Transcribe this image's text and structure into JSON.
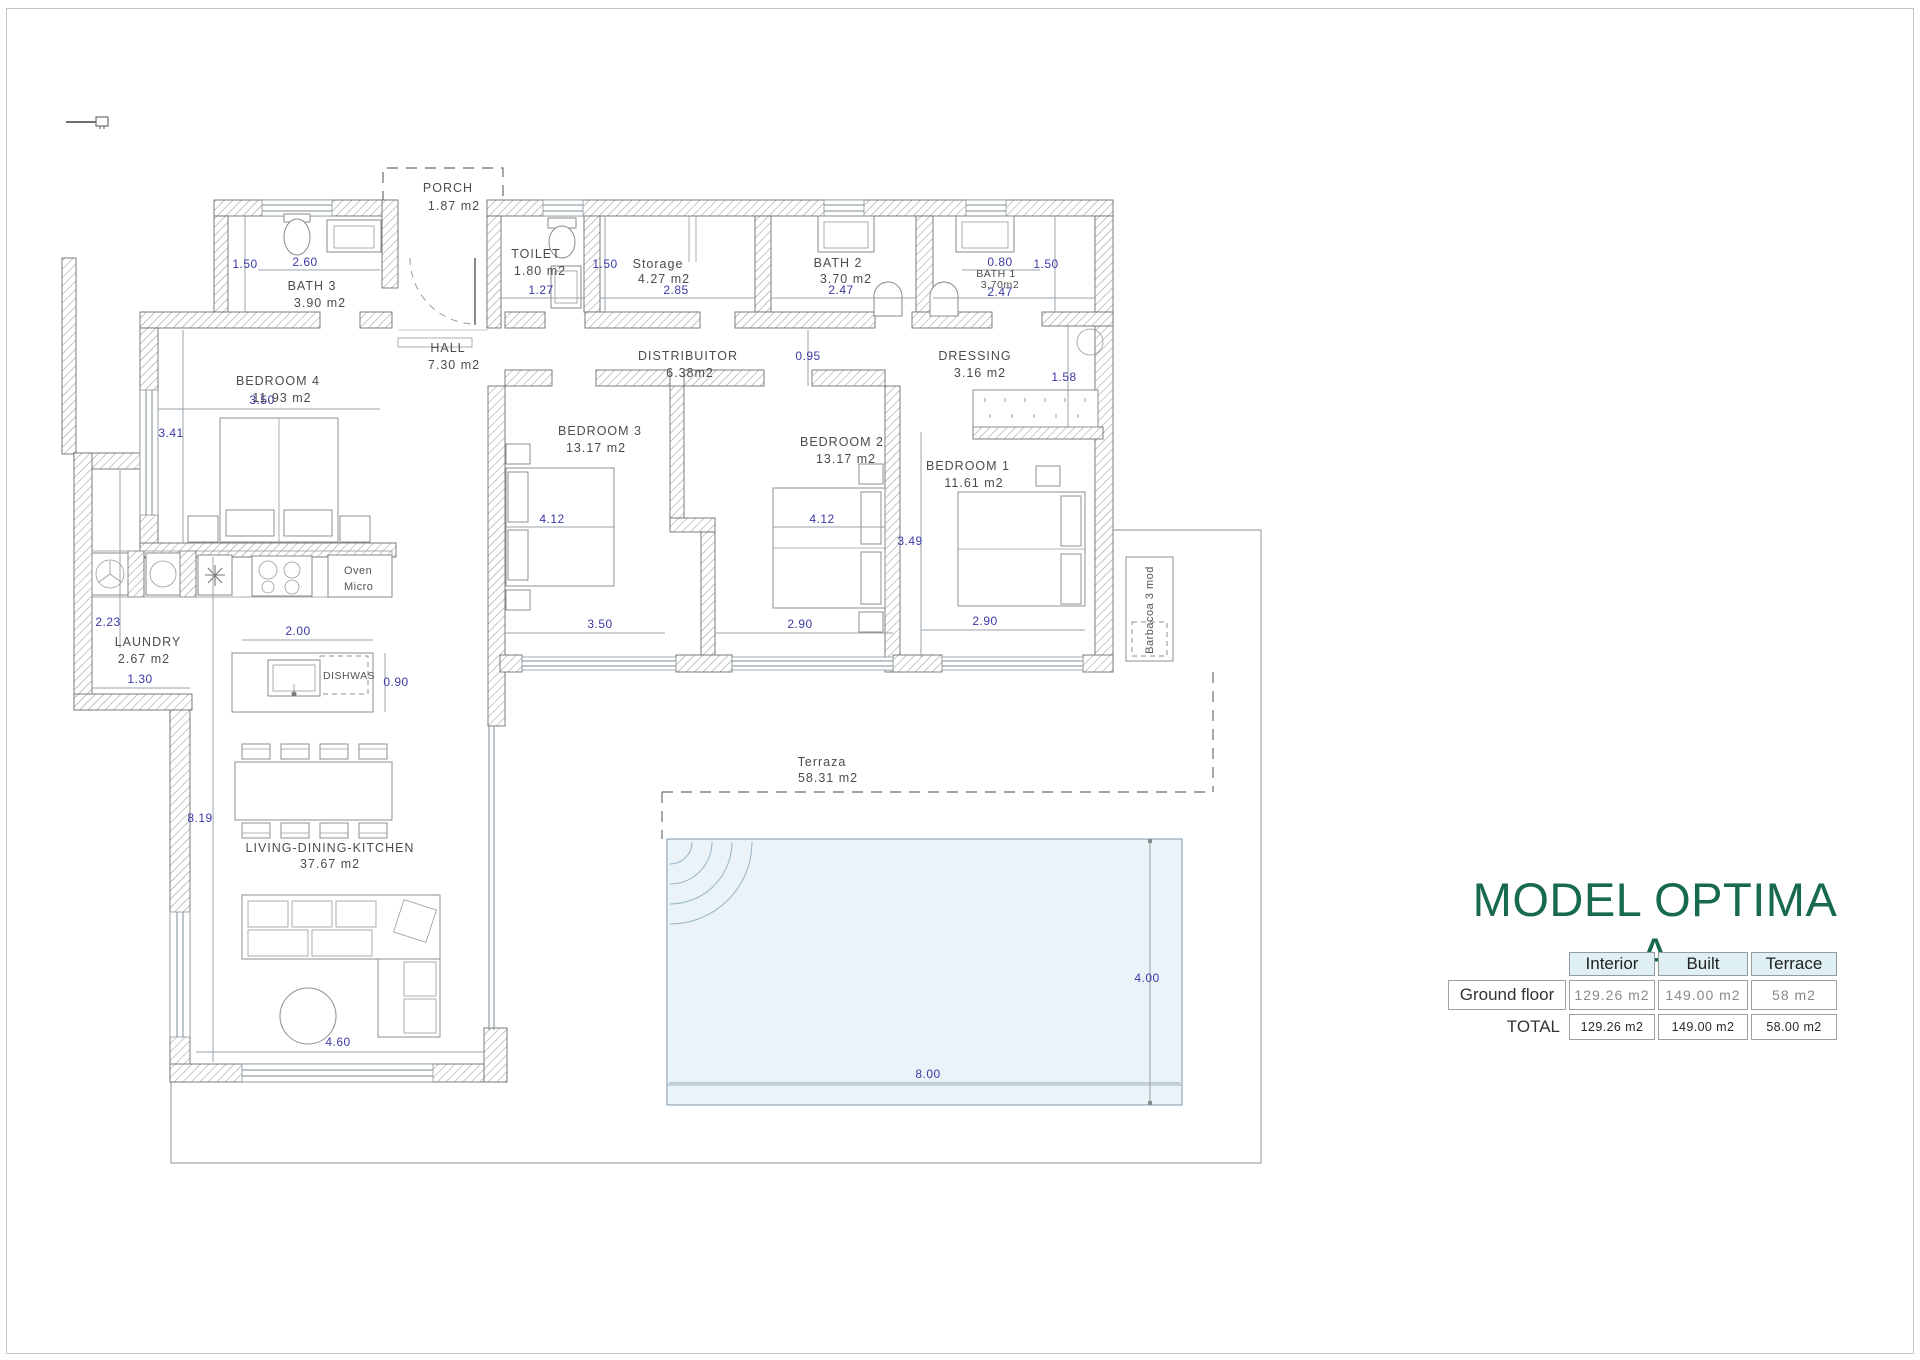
{
  "page": {
    "title": "MODEL OPTIMA A"
  },
  "summary_table": {
    "col_headers": [
      "Interior",
      "Built",
      "Terrace"
    ],
    "rows": [
      {
        "label": "Ground floor",
        "interior": "129.26  m2",
        "built": "149.00  m2",
        "terrace": "58  m2"
      },
      {
        "label": "TOTAL",
        "interior": "129.26 m2",
        "built": "149.00 m2",
        "terrace": "58.00 m2"
      }
    ]
  },
  "rooms": {
    "porch": {
      "name": "PORCH",
      "area": "1.87  m2"
    },
    "bath3": {
      "name": "BATH  3",
      "area": "3.90  m2"
    },
    "toilet": {
      "name": "TOILET",
      "area": "1.80  m2"
    },
    "storage": {
      "name": "Storage",
      "area": "4.27  m2"
    },
    "bath2": {
      "name": "BATH  2",
      "area": "3.70  m2"
    },
    "bath1": {
      "name": "BATH  1",
      "area": "3.70m2"
    },
    "hall": {
      "name": "HALL",
      "area": "7.30  m2"
    },
    "distribuitor": {
      "name": "DISTRIBUITOR",
      "area": "6.38m2"
    },
    "dressing": {
      "name": "DRESSING",
      "area": "3.16  m2"
    },
    "bedroom4": {
      "name": "BEDROOM  4",
      "area": "11.93  m2"
    },
    "bedroom3": {
      "name": "BEDROOM  3",
      "area": "13.17  m2"
    },
    "bedroom2": {
      "name": "BEDROOM  2",
      "area": "13.17  m2"
    },
    "bedroom1": {
      "name": "BEDROOM  1",
      "area": "11.61  m2"
    },
    "laundry": {
      "name": "LAUNDRY",
      "area": "2.67  m2"
    },
    "living": {
      "name": "LIVING-DINING-KITCHEN",
      "area": "37.67  m2"
    },
    "terrace": {
      "name": "Terraza",
      "area": "58.31  m2"
    }
  },
  "dims": {
    "bath3_width": "1.50",
    "bath3_length": "2.60",
    "toilet_width": "1.27",
    "storage_height": "1.50",
    "storage_width": "2.85",
    "bath2_width": "2.47",
    "bath1_door": "0.80",
    "bath1_height": "1.50",
    "bath1_width": "2.47",
    "corridor_width": "0.95",
    "dressing_width": "1.58",
    "bedroom4_width": "3.50",
    "bedroom4_height": "3.41",
    "bedroom3_bed": "4.12",
    "bedroom3_width": "3.50",
    "bedroom2_bed": "4.12",
    "bedroom2_width": "2.90",
    "bedroom1_height": "3.49",
    "bedroom1_width": "2.90",
    "laundry_height": "2.23",
    "laundry_width": "1.30",
    "island_width": "2.00",
    "island_depth": "0.90",
    "living_height": "8.19",
    "living_width": "4.60",
    "pool_height": "4.00",
    "pool_width": "8.00"
  },
  "labels": {
    "oven": "Oven",
    "micro": "Micro",
    "dishwasher": "DISHWAS",
    "barbecue": "Barbacoa  3  mod"
  },
  "colors": {
    "title_green": "#17694f",
    "dimension_blue": "#3a3aa6",
    "table_header_bg": "#dff0f4",
    "pool_fill": "#eaf3f8"
  }
}
